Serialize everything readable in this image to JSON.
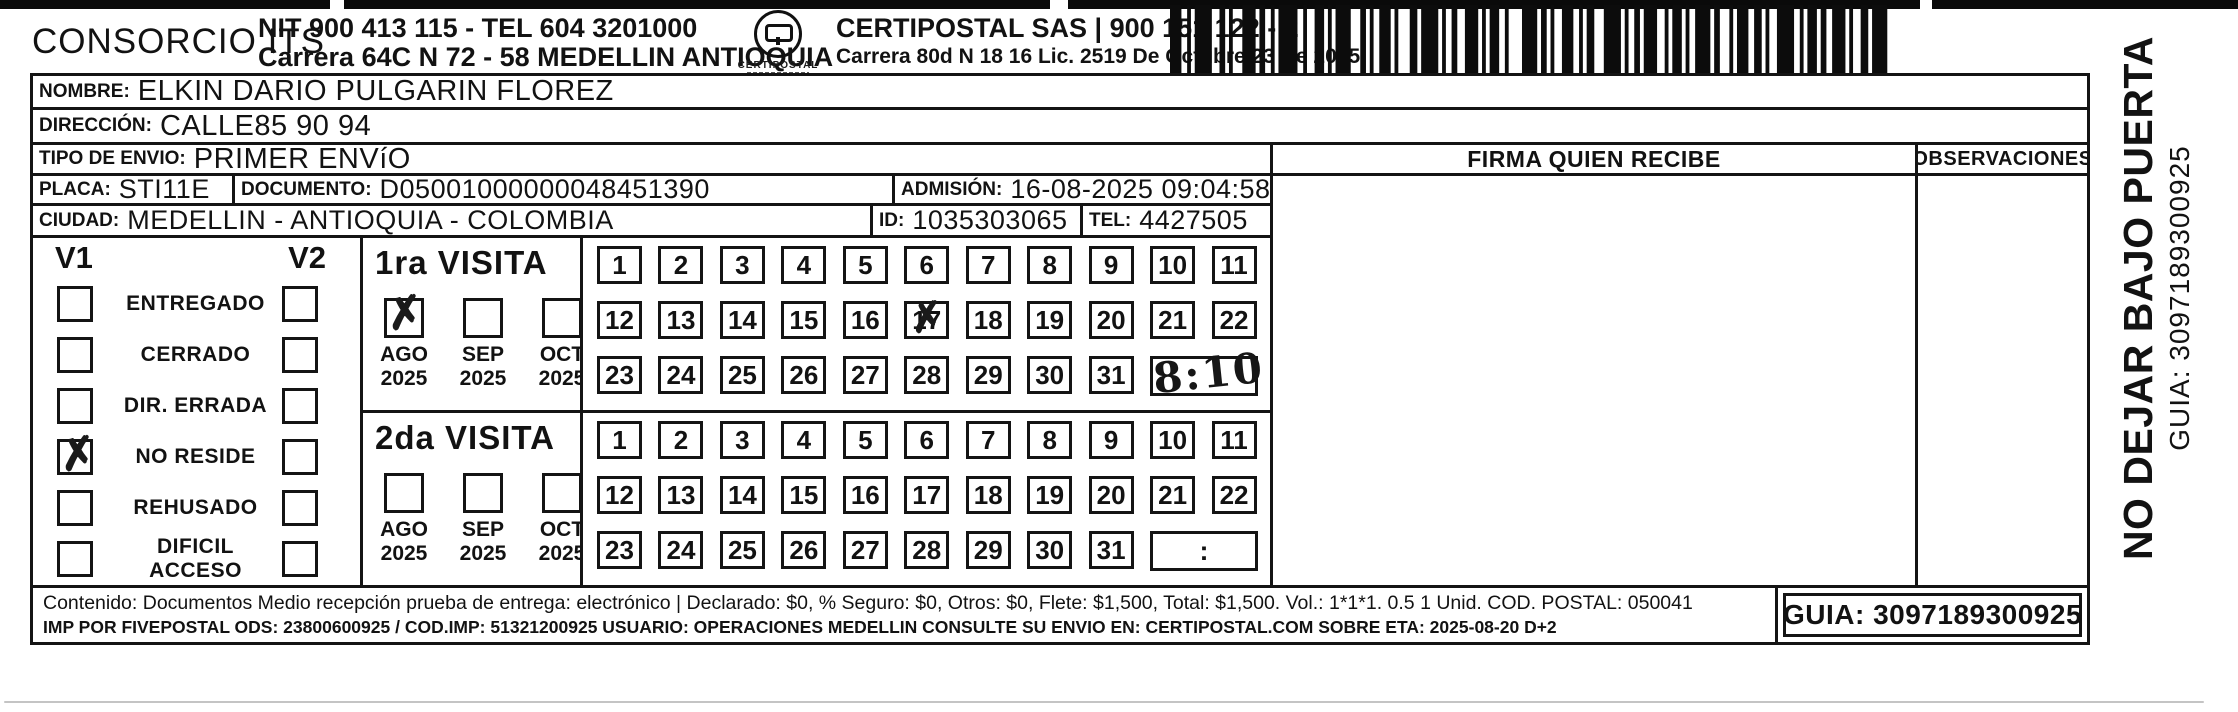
{
  "header": {
    "company": "CONSORCIO ITS",
    "line1": "NIT 900 413 115 - TEL 604 3201000",
    "line2": "Carrera 64C N 72 - 58 MEDELLIN ANTIOQUIA",
    "logo_caption": "CERTIPOSTAL",
    "provider_line1": "CERTIPOSTAL SAS | 900 151 122 - 2",
    "provider_line2": "Carrera 80d N 18 16  Lic. 2519 De Octubre 23 De 2015"
  },
  "fields": {
    "nombre_label": "NOMBRE:",
    "nombre_value": "ELKIN DARIO PULGARIN FLOREZ",
    "direccion_label": "DIRECCIÓN:",
    "direccion_value": "CALLE85 90 94",
    "tipo_label": "TIPO DE ENVIO:",
    "tipo_value": "PRIMER ENVíO",
    "placa_label": "PLACA:",
    "placa_value": "STI11E",
    "documento_label": "DOCUMENTO:",
    "documento_value": "D05001000000048451390",
    "admision_label": "ADMISIÓN:",
    "admision_value": "16-08-2025 09:04:58",
    "ciudad_label": "CIUDAD:",
    "ciudad_value": "MEDELLIN - ANTIOQUIA - COLOMBIA",
    "id_label": "ID:",
    "id_value": "1035303065",
    "tel_label": "TEL:",
    "tel_value": "4427505"
  },
  "signature": {
    "firma_header": "FIRMA QUIEN RECIBE",
    "observaciones_header": "OBSERVACIONES"
  },
  "delivery_status": {
    "col1": "V1",
    "col2": "V2",
    "rows": [
      {
        "label": "ENTREGADO",
        "v1": false,
        "v2": false
      },
      {
        "label": "CERRADO",
        "v1": false,
        "v2": false
      },
      {
        "label": "DIR. ERRADA",
        "v1": false,
        "v2": false
      },
      {
        "label": "NO RESIDE",
        "v1": true,
        "v2": false
      },
      {
        "label": "REHUSADO",
        "v1": false,
        "v2": false
      },
      {
        "label": "DIFICIL ACCESO",
        "v1": false,
        "v2": false
      }
    ]
  },
  "visits": [
    {
      "title": "1ra VISITA",
      "months": [
        {
          "month": "AGO",
          "year": "2025",
          "checked": true
        },
        {
          "month": "SEP",
          "year": "2025",
          "checked": false
        },
        {
          "month": "OCT",
          "year": "2025",
          "checked": false
        }
      ],
      "days": [
        1,
        2,
        3,
        4,
        5,
        6,
        7,
        8,
        9,
        10,
        11,
        12,
        13,
        14,
        15,
        16,
        17,
        18,
        19,
        20,
        21,
        22,
        23,
        24,
        25,
        26,
        27,
        28,
        29,
        30,
        31
      ],
      "marked_day": 17,
      "time": "8:10"
    },
    {
      "title": "2da VISITA",
      "months": [
        {
          "month": "AGO",
          "year": "2025",
          "checked": false
        },
        {
          "month": "SEP",
          "year": "2025",
          "checked": false
        },
        {
          "month": "OCT",
          "year": "2025",
          "checked": false
        }
      ],
      "days": [
        1,
        2,
        3,
        4,
        5,
        6,
        7,
        8,
        9,
        10,
        11,
        12,
        13,
        14,
        15,
        16,
        17,
        18,
        19,
        20,
        21,
        22,
        23,
        24,
        25,
        26,
        27,
        28,
        29,
        30,
        31
      ],
      "marked_day": null,
      "time": ""
    }
  ],
  "grid": {
    "time_placeholder": ":"
  },
  "icons": {
    "x_mark": "✗"
  },
  "footer": {
    "line1": "Contenido: Documentos Medio recepción prueba de entrega: electrónico | Declarado: $0, % Seguro: $0, Otros: $0, Flete: $1,500, Total: $1,500. Vol.: 1*1*1. 0.5  1 Unid. COD. POSTAL: 050041",
    "line2": "IMP POR FIVEPOSTAL ODS: 23800600925 / COD.IMP: 51321200925 USUARIO: OPERACIONES MEDELLIN CONSULTE SU ENVIO EN: CERTIPOSTAL.COM SOBRE ETA: 2025-08-20 D+2",
    "guia": "GUIA: 3097189300925"
  },
  "side_note": {
    "line1": "NO DEJAR BAJO PUERTA",
    "line2": "GUIA: 3097189300925"
  },
  "colors": {
    "ink": "#121212",
    "paper": "#ffffff"
  }
}
